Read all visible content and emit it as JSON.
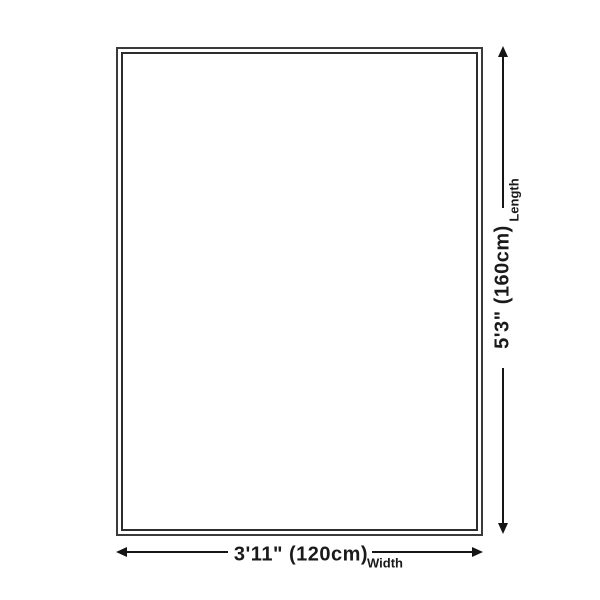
{
  "rug_diagram": {
    "length": {
      "value": "5'3\" (160cm)",
      "label": "Length"
    },
    "width": {
      "value": "3'11\" (120cm)",
      "label": "Width"
    },
    "colors": {
      "background": "#ffffff",
      "line": "#151515",
      "text": "#1a1a1a",
      "border_outer": "#3a3a3a",
      "border_inner": "#2d2d2d"
    }
  }
}
